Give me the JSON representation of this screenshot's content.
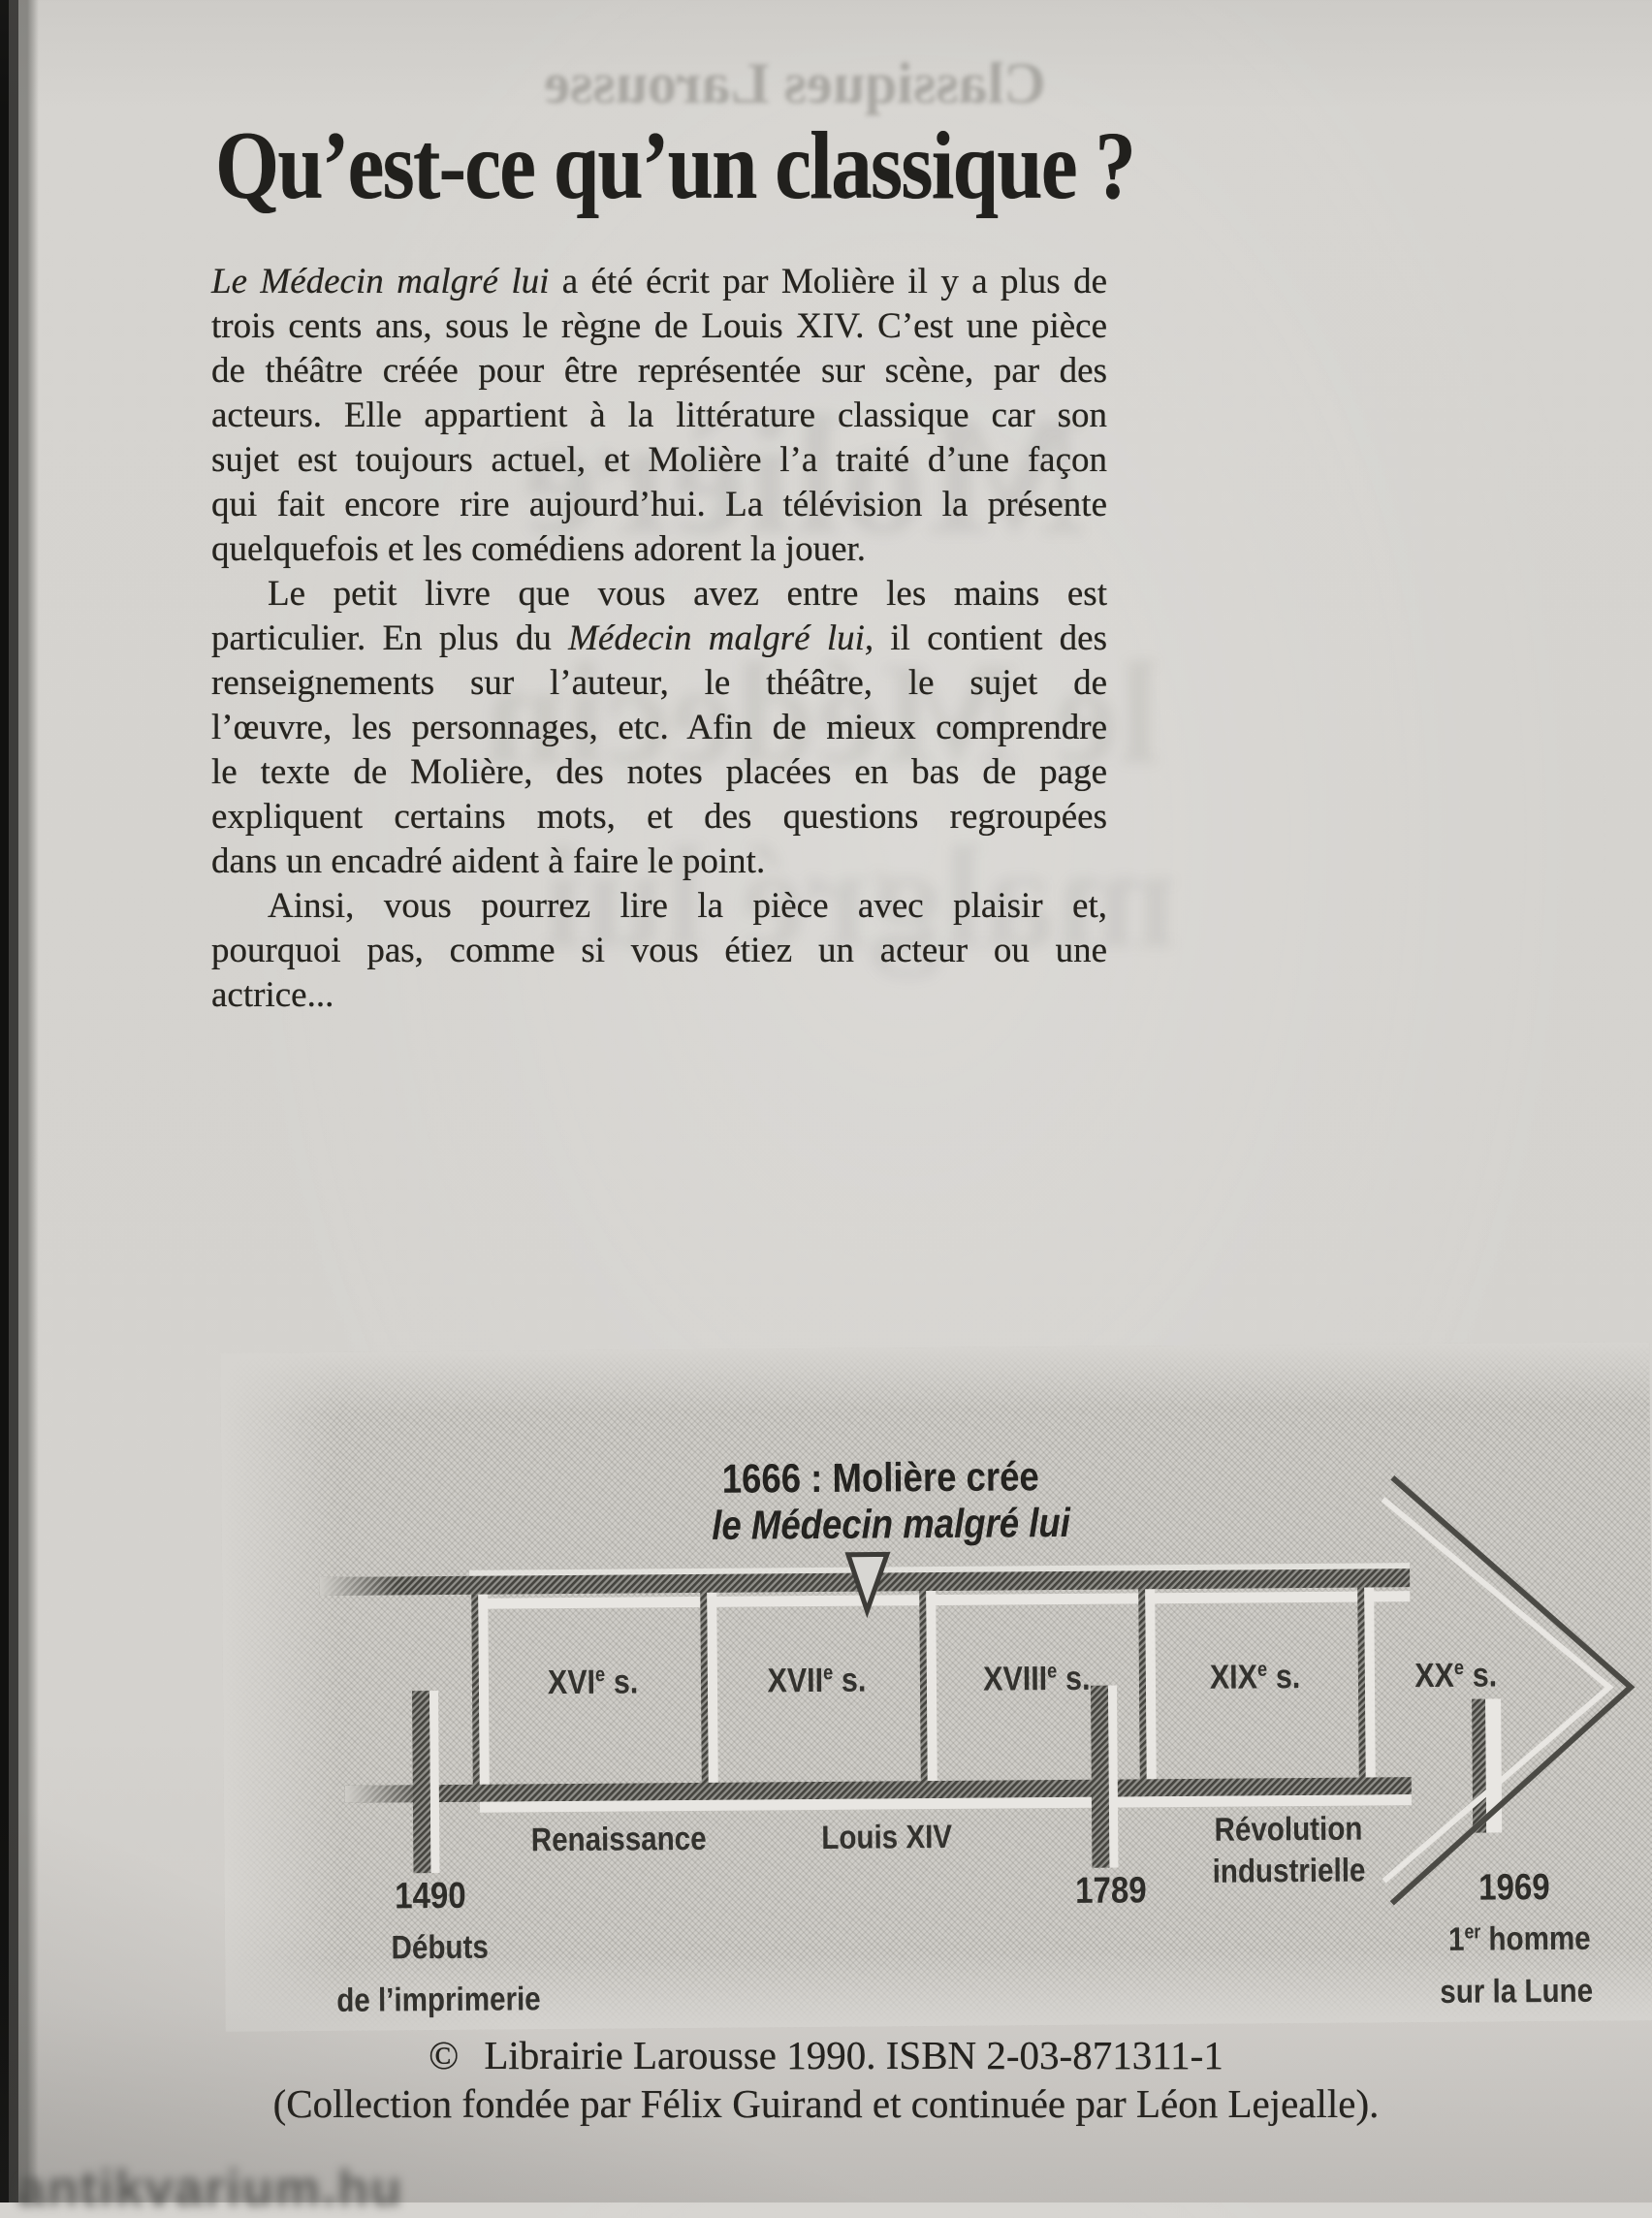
{
  "page": {
    "title": "Qu’est-ce qu’un classique ?"
  },
  "ghosts": {
    "top": "Classiques Larousse",
    "mid1": "Molière",
    "mid2": "le Médecin",
    "mid3": "malgré lui"
  },
  "watermark": "antikvarium.hu",
  "body": {
    "paragraphs": [
      {
        "lines": [
          {
            "segments": [
              {
                "t": "Le Médecin malgré lui",
                "i": true
              },
              {
                "t": " a été écrit par Molière il y a plus de",
                "i": false
              }
            ]
          },
          {
            "segments": [
              {
                "t": "trois cents ans, sous le règne de Louis XIV. C’est une pièce"
              }
            ]
          },
          {
            "segments": [
              {
                "t": "de théâtre créée pour être représentée sur scène, par des"
              }
            ]
          },
          {
            "segments": [
              {
                "t": "acteurs. Elle appartient à la littérature classique car son"
              }
            ]
          },
          {
            "segments": [
              {
                "t": "sujet est toujours actuel, et Molière l’a traité d’une façon"
              }
            ]
          },
          {
            "segments": [
              {
                "t": "qui fait encore rire aujourd’hui. La télévision la présente"
              }
            ]
          },
          {
            "segments": [
              {
                "t": "quelquefois et les comédiens adorent la jouer."
              }
            ]
          }
        ]
      },
      {
        "lines": [
          {
            "segments": [
              {
                "t": "Le petit livre que vous avez entre les mains est"
              }
            ]
          },
          {
            "segments": [
              {
                "t": "particulier. En plus du ",
                "i": false
              },
              {
                "t": "Médecin malgré lui,",
                "i": true
              },
              {
                "t": " il contient des",
                "i": false
              }
            ]
          },
          {
            "segments": [
              {
                "t": "renseignements sur l’auteur, le théâtre, le sujet de"
              }
            ]
          },
          {
            "segments": [
              {
                "t": "l’œuvre, les personnages, etc. Afin de mieux comprendre"
              }
            ]
          },
          {
            "segments": [
              {
                "t": "le texte de Molière, des notes placées en bas de page"
              }
            ]
          },
          {
            "segments": [
              {
                "t": "expliquent certains mots, et des questions regroupées"
              }
            ]
          },
          {
            "segments": [
              {
                "t": "dans un encadré aident à faire le point."
              }
            ]
          }
        ]
      },
      {
        "lines": [
          {
            "segments": [
              {
                "t": "Ainsi, vous pourrez lire la pièce avec plaisir et,"
              }
            ]
          },
          {
            "segments": [
              {
                "t": "pourquoi pas, comme si vous étiez un acteur ou une"
              }
            ]
          },
          {
            "segments": [
              {
                "t": "actrice..."
              }
            ]
          }
        ]
      }
    ]
  },
  "timeline": {
    "event": {
      "line1": "1666 : Molière crée",
      "line2": "le Médecin malgré lui"
    },
    "centuries": [
      {
        "roman": "XVI",
        "sup": "e",
        "suffix": "s."
      },
      {
        "roman": "XVII",
        "sup": "e",
        "suffix": "s."
      },
      {
        "roman": "XVIII",
        "sup": "e",
        "suffix": "s."
      },
      {
        "roman": "XIX",
        "sup": "e",
        "suffix": "s."
      },
      {
        "roman": "XX",
        "sup": "e",
        "suffix": "s."
      }
    ],
    "eras": {
      "era1": "Renaissance",
      "era2": "Louis XIV",
      "era3_line1": "Révolution",
      "era3_line2": "industrielle"
    },
    "years": {
      "y1": "1490",
      "y2": "1789",
      "y3": "1969"
    },
    "captions": {
      "c1_line1": "Débuts",
      "c1_line2": "de l’imprimerie",
      "c3_pre": "1",
      "c3_sup": "er",
      "c3_post": " homme",
      "c3_line2": "sur la Lune"
    }
  },
  "footer": {
    "copyright_symbol": "©",
    "copyright": "Librairie Larousse 1990. ISBN 2-03-871311-1",
    "collection": "(Collection fondée par Félix Guirand et continuée par Léon Lejealle)."
  },
  "colors": {
    "paper": "#d5d3cf",
    "ink": "#26241f",
    "diagram_hatch_dark": "#45443f",
    "diagram_highlight": "#e8e6e2"
  }
}
